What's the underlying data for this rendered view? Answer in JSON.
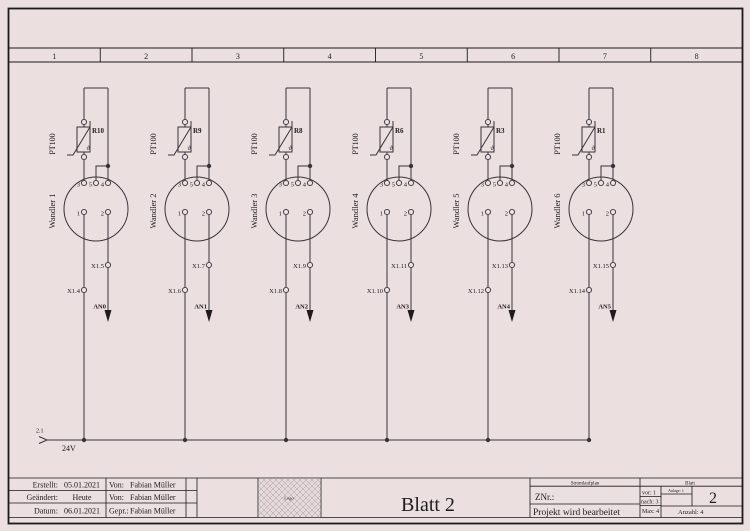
{
  "page": {
    "bg": "#ebdfe0",
    "wire_color": "#3a333a",
    "border_color": "#1a1a1a"
  },
  "ruler": {
    "cells": [
      "1",
      "2",
      "3",
      "4",
      "5",
      "6",
      "7",
      "8"
    ]
  },
  "bus": {
    "ref": "2.1",
    "label": "24V"
  },
  "channels": [
    {
      "sensor": "PT100",
      "resistor": "R10",
      "theta": "ϑ",
      "converter": "Wandler 1",
      "top_terminals": [
        "3",
        "5",
        "4"
      ],
      "bottom_terminals": [
        "1",
        "2"
      ],
      "left_terminal": "X1.4",
      "right_terminal": "X1.5",
      "output": "AN0"
    },
    {
      "sensor": "PT100",
      "resistor": "R9",
      "theta": "ϑ",
      "converter": "Wandler 2",
      "top_terminals": [
        "3",
        "5",
        "4"
      ],
      "bottom_terminals": [
        "1",
        "2"
      ],
      "left_terminal": "X1.6",
      "right_terminal": "X1.7",
      "output": "AN1"
    },
    {
      "sensor": "PT100",
      "resistor": "R8",
      "theta": "ϑ",
      "converter": "Wandler 3",
      "top_terminals": [
        "3",
        "5",
        "4"
      ],
      "bottom_terminals": [
        "1",
        "2"
      ],
      "left_terminal": "X1.8",
      "right_terminal": "X1.9",
      "output": "AN2"
    },
    {
      "sensor": "PT100",
      "resistor": "R6",
      "theta": "ϑ",
      "converter": "Wandler 4",
      "top_terminals": [
        "3",
        "5",
        "4"
      ],
      "bottom_terminals": [
        "1",
        "2"
      ],
      "left_terminal": "X1.10",
      "right_terminal": "X1.11",
      "output": "AN3"
    },
    {
      "sensor": "PT100",
      "resistor": "R3",
      "theta": "ϑ",
      "converter": "Wandler 5",
      "top_terminals": [
        "3",
        "5",
        "4"
      ],
      "bottom_terminals": [
        "1",
        "2"
      ],
      "left_terminal": "X1.12",
      "right_terminal": "X1.13",
      "output": "AN4"
    },
    {
      "sensor": "PT100",
      "resistor": "R1",
      "theta": "ϑ",
      "converter": "Wandler 6",
      "top_terminals": [
        "3",
        "5",
        "4"
      ],
      "bottom_terminals": [
        "1",
        "2"
      ],
      "left_terminal": "X1.14",
      "right_terminal": "X1.15",
      "output": "AN5"
    }
  ],
  "title_block": {
    "rows": [
      {
        "label": "Erstellt:",
        "value": "05.01.2021",
        "by_label": "Von:",
        "by": "Fabian Müller"
      },
      {
        "label": "Geändert:",
        "value": "Heute",
        "by_label": "Von:",
        "by": "Fabian Müller"
      },
      {
        "label": "Datum:",
        "value": "06.01.2021",
        "by_label": "Gepr.:",
        "by": "Fabian Müller"
      }
    ],
    "logo": "Logo",
    "sheet_title": "Blatt 2",
    "doc_type": "Stromlaufplan",
    "znr_label": "ZNr.:",
    "project_status": "Projekt wird bearbeitet",
    "blatt_header": "Blatt",
    "vor": "vor: 1",
    "nach": "nach: 3",
    "max": "Max: 4",
    "anlage": "Anlage: 1",
    "anzahl": "Anzahl: 4",
    "sheet_number": "2"
  }
}
